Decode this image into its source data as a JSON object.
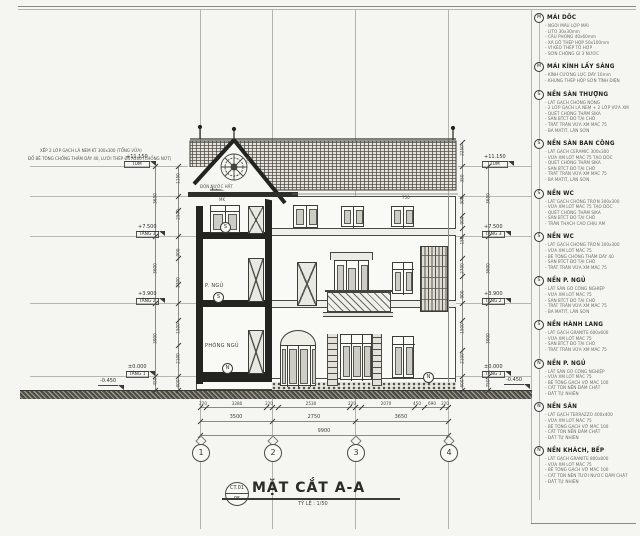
{
  "sheet": {
    "title": "MẶT CẮT A-A",
    "scale": "TỶ LỆ : 1/50",
    "code": "CT.01",
    "code_bottom": "05"
  },
  "grid": {
    "bubbles": [
      "1",
      "2",
      "3",
      "4"
    ]
  },
  "levels": [
    {
      "value": "+11.150",
      "name": "TUM"
    },
    {
      "value": "+7.500",
      "name": "TẦNG 3"
    },
    {
      "value": "+3.900",
      "name": "TẦNG 2"
    },
    {
      "value": "±0.000",
      "name": "TẦNG 1"
    },
    {
      "value": "-0.450",
      "name": "SÂN"
    }
  ],
  "rooms": {
    "bedroom_ground": "PHÒNG NGỦ",
    "bedroom_upper": "P. NGỦ"
  },
  "markers": {
    "s": "S",
    "n": "N"
  },
  "roof": {
    "note1": "XẾP 2 LỚP GẠCH LÁ NEM KT 300x300 (TỔNG VỮA)",
    "note2": "ĐỔ BÊ TÔNG CHỐNG THẤM DÀY 40, LƯỚI THÉP Ø4 A200 (CHỐNG NỨT)",
    "drip": "ĐÓN NƯỚC HẮT"
  },
  "dims": {
    "left_main": [
      "3650",
      "3600",
      "3900",
      "450"
    ],
    "left_fine": [
      "1150",
      "2500",
      "900",
      "2700",
      "1500",
      "2100",
      "600"
    ],
    "right_fine": [
      "2250",
      "350",
      "300",
      "900",
      "150",
      "2700",
      "900",
      "1500",
      "2100",
      "600"
    ],
    "right_main": [
      "3650",
      "3600",
      "3900",
      "750"
    ],
    "bottom_detail": [
      "220",
      "3280",
      "220",
      "2530",
      "220",
      "2070",
      "450",
      "690",
      "220"
    ],
    "bottom_axis": [
      "3500",
      "2750",
      "3650"
    ],
    "bottom_total": "9900",
    "misc": {
      "eave": "750",
      "rose": "750",
      "mk": "MK"
    }
  },
  "sidebar": {
    "notes": [
      {
        "marker": "M",
        "title": "MÁI DỐC",
        "lines": [
          "- NGÓI MÀU LỢP MÁI",
          "- LITO 30x30mm",
          "- CẦU PHONG 40x60mm",
          "- XÀ GỒ THÉP HỘP 50x100mm",
          "- VÌ KÈO THÉP TỔ HỢP",
          "- SƠN CHỐNG GỈ 3 NƯỚC"
        ]
      },
      {
        "marker": "M",
        "title": "MÁI KÍNH LẤY SÁNG",
        "lines": [
          "- KÍNH CƯỜNG LỰC DÀY 10mm",
          "- KHUNG THÉP HỘP SƠN TĨNH ĐIỆN"
        ]
      },
      {
        "marker": "S",
        "title": "NỀN SÀN THƯỢNG",
        "lines": [
          "- LÁT GẠCH CHỐNG NÓNG",
          "- 2 LỚP GẠCH LÁ NEM + 2 LỚP VỮA XM",
          "- QUÉT CHỐNG THẤM SIKA",
          "- SÀN BTCT ĐỔ TẠI CHỖ",
          "- TRÁT TRẦN VỮA XM MÁC 75",
          "- BẢ MATIT, LĂN SƠN"
        ]
      },
      {
        "marker": "S",
        "title": "NỀN SÀN BAN CÔNG",
        "lines": [
          "- LÁT GẠCH CERAMIC 300x300",
          "- VỮA XM LÓT MÁC 75 TẠO DỐC",
          "- QUÉT CHỐNG THẤM SIKA",
          "- SÀN BTCT ĐỔ TẠI CHỖ",
          "- TRÁT TRẦN VỮA XM MÁC 75",
          "- BẢ MATIT, LĂN SƠN"
        ]
      },
      {
        "marker": "S",
        "title": "NỀN WC",
        "lines": [
          "- LÁT GẠCH CHỐNG TRƠN 300x300",
          "- VỮA XM LÓT MÁC 75 TẠO DỐC",
          "- QUÉT CHỐNG THẤM SIKA",
          "- SÀN BTCT ĐỔ TẠI CHỖ",
          "- TRẦN THẠCH CAO CHỊU ẨM"
        ]
      },
      {
        "marker": "S",
        "title": "NỀN WC",
        "lines": [
          "- LÁT GẠCH CHỐNG TRƠN 300x300",
          "- VỮA XM LÓT MÁC 75",
          "- BÊ TÔNG CHỐNG THẤM DÀY 40",
          "- SÀN BTCT ĐỔ TẠI CHỖ",
          "- TRÁT TRẦN VỮA XM MÁC 75"
        ]
      },
      {
        "marker": "S",
        "title": "NỀN P. NGỦ",
        "lines": [
          "- LÁT SÀN GỖ CÔNG NGHIỆP",
          "- VỮA XM LÓT MÁC 75",
          "- SÀN BTCT ĐỔ TẠI CHỖ",
          "- TRÁT TRẦN VỮA XM MÁC 75",
          "- BẢ MATIT, LĂN SƠN"
        ]
      },
      {
        "marker": "S",
        "title": "NỀN HÀNH LANG",
        "lines": [
          "- LÁT GẠCH GRANITE 600x600",
          "- VỮA XM LÓT MÁC 75",
          "- SÀN BTCT ĐỔ TẠI CHỖ",
          "- TRÁT TRẦN VỮA XM MÁC 75"
        ]
      },
      {
        "marker": "N",
        "title": "NỀN P. NGỦ",
        "lines": [
          "- LÁT SÀN GỖ CÔNG NGHIỆP",
          "- VỮA XM LÓT MÁC 75",
          "- BÊ TÔNG GẠCH VỠ MÁC 100",
          "- CÁT TÔN NỀN ĐẦM CHẶT",
          "- ĐẤT TỰ NHIÊN"
        ]
      },
      {
        "marker": "N",
        "title": "NỀN SÂN",
        "lines": [
          "- LÁT GẠCH TERRAZZO 400x400",
          "- VỮA XM LÓT MÁC 75",
          "- BÊ TÔNG GẠCH VỠ MÁC 100",
          "- CÁT TÔN NỀN ĐẦM CHẶT",
          "- ĐẤT TỰ NHIÊN"
        ]
      },
      {
        "marker": "N",
        "title": "NỀN KHÁCH, BẾP",
        "lines": [
          "- LÁT GẠCH GRANITE 800x800",
          "- VỮA XM LÓT MÁC 75",
          "- BÊ TÔNG GẠCH VỠ MÁC 100",
          "- CÁT TÔN NỀN TƯỚI NƯỚC ĐẦM CHẶT",
          "- ĐẤT TỰ NHIÊN"
        ]
      }
    ]
  }
}
